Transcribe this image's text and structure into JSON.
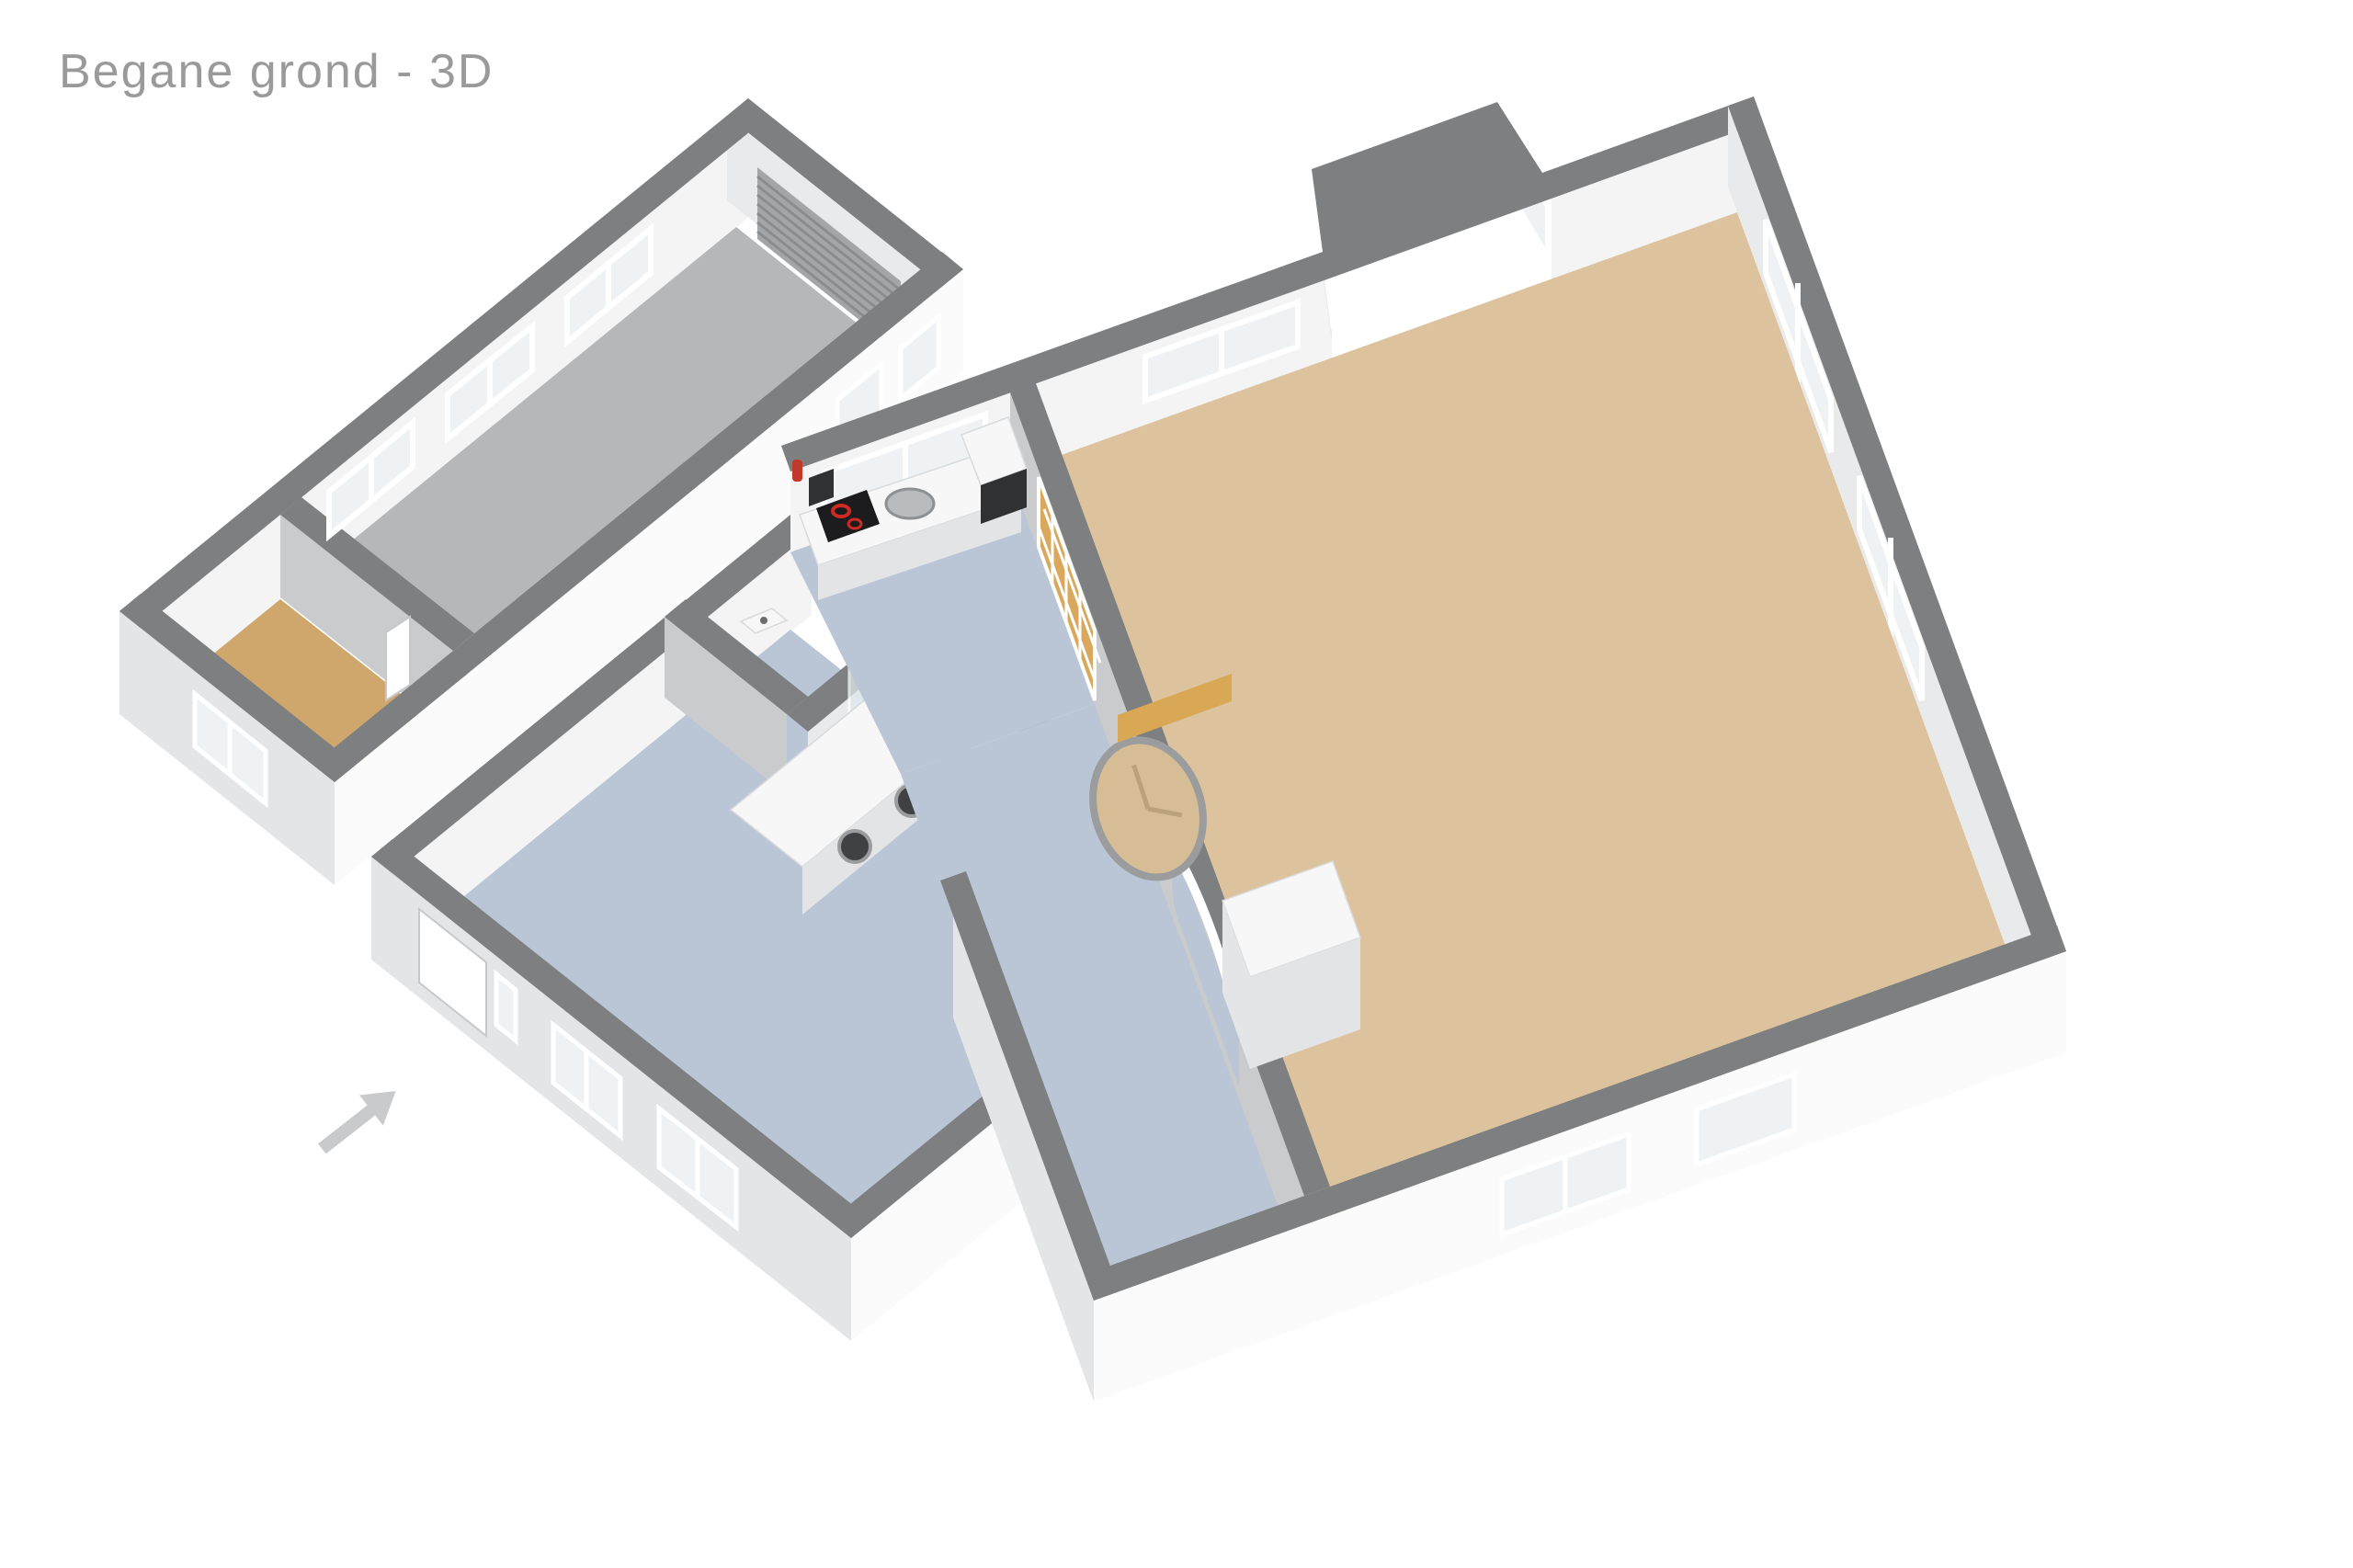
{
  "page": {
    "title": "Begane grond - 3D"
  },
  "colors": {
    "title_text": "#9a9a9a",
    "wall_band": "#7d7f81",
    "wall_int_lit": "#f4f4f5",
    "wall_int_mid": "#e9eaeb",
    "wall_int_dark": "#c9cbcd",
    "wall_ext_bright": "#fbfbfb",
    "wall_ext_shade": "#e4e5e6",
    "glass": "#eef2f5",
    "floor_garage": "#b6b7b9",
    "floor_storage": "#cfa76d",
    "floor_hall": "#bac6d6",
    "floor_kitchen": "#bac6d6",
    "floor_living": "#dcc39d",
    "roll_door": "#a3a5a7",
    "bench": "#d9a854",
    "clock_face": "#d7bd95",
    "clock_rim": "#9a9c9e",
    "cooktop": "#1c1c1e",
    "burner": "#cc2a22",
    "appliance_dark": "#3f4144",
    "extinguisher": "#c0392b",
    "panel_black": "#2f3133",
    "arrow": "#c9cacc",
    "sink_metal": "#b9bcbe"
  },
  "rooms": [
    {
      "name": "garage",
      "floor": "concrete-gray"
    },
    {
      "name": "storage",
      "floor": "wood-tan"
    },
    {
      "name": "hall-utility",
      "floor": "blue-gray"
    },
    {
      "name": "toilet",
      "floor": "blue-gray"
    },
    {
      "name": "shower",
      "floor": "blue-gray"
    },
    {
      "name": "kitchen",
      "floor": "blue-gray"
    },
    {
      "name": "living-room",
      "floor": "beige-tan"
    }
  ],
  "fixtures": [
    "sectional-garage-door",
    "storage-window",
    "storage-door",
    "front-door",
    "entrance-arrow",
    "utility-counter-with-washers",
    "utility-sink",
    "toilet-basin",
    "shower-glass",
    "kitchen-counter",
    "round-kitchen-sink",
    "cooktop",
    "microwave",
    "fire-extinguisher",
    "boiler-panel",
    "interior-glass-door",
    "arch-opening",
    "wall-clock",
    "wall-bench",
    "tall-cabinets",
    "bay-window",
    "living-windows",
    "garage-windows"
  ]
}
